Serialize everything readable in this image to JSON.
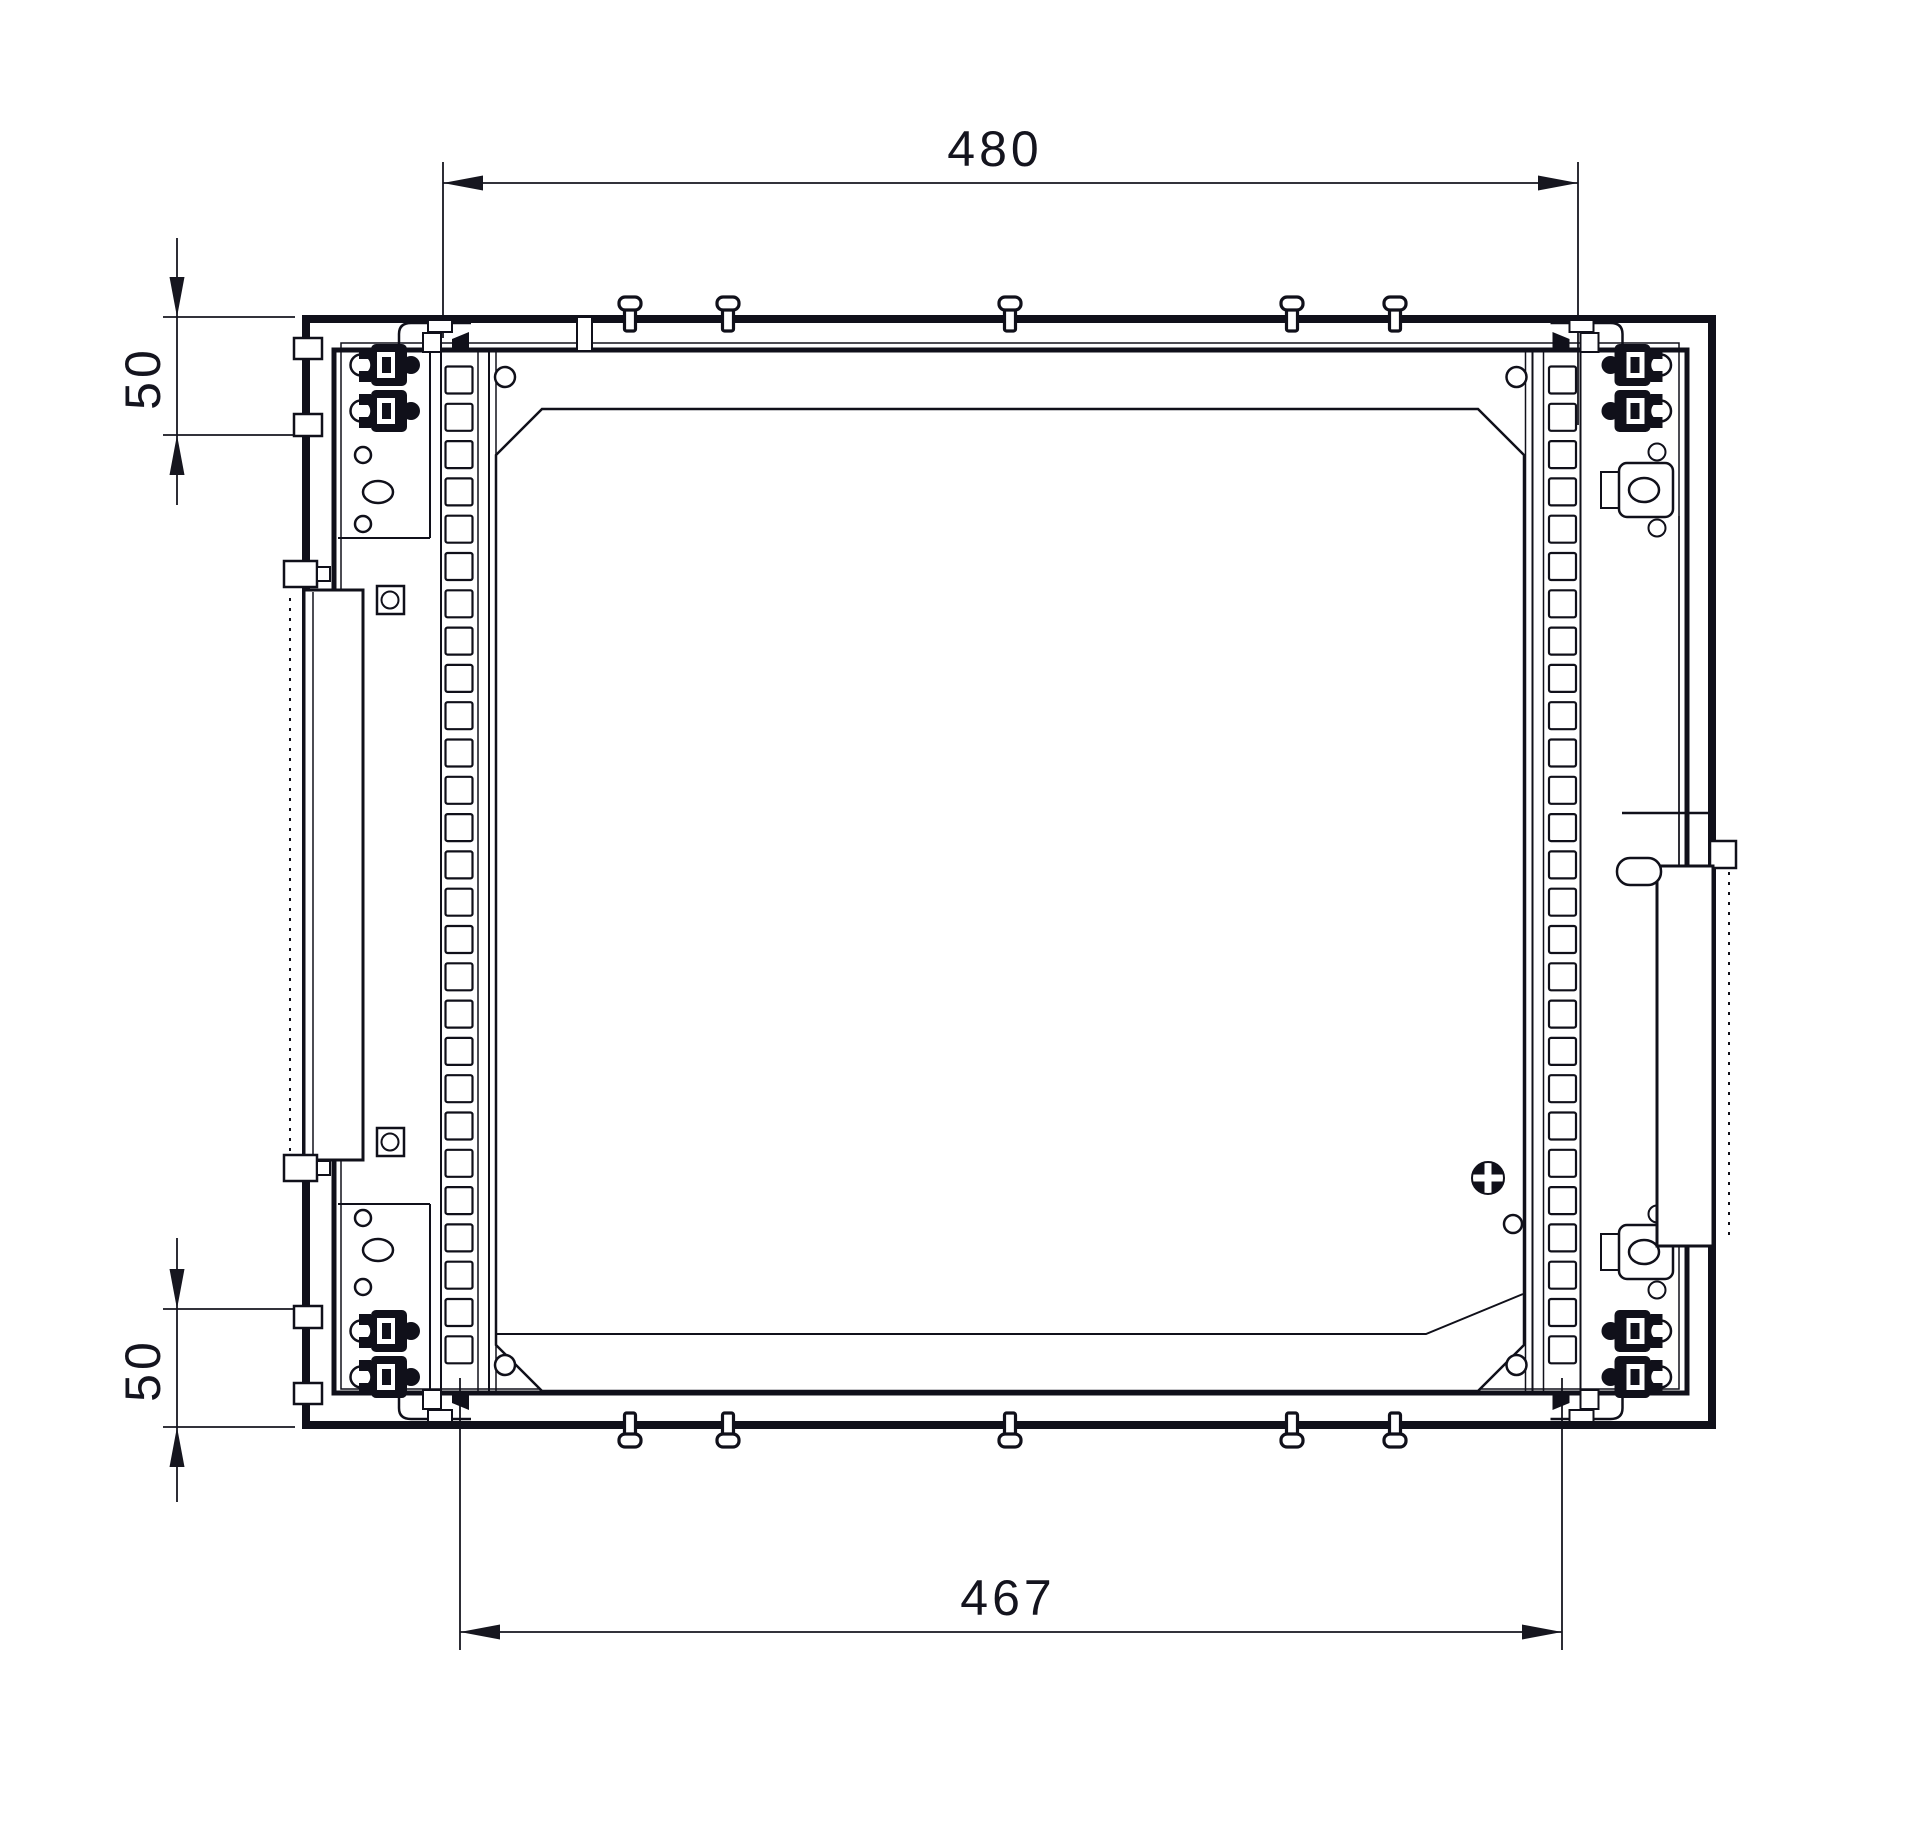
{
  "drawing": {
    "type": "technical-cad-drawing",
    "subject": "rack-mount frame, top view with mounting rails",
    "background": "#ffffff",
    "line_color": "#10101a",
    "dimensions": [
      {
        "id": "top-width",
        "value": "480"
      },
      {
        "id": "bottom-width",
        "value": "467"
      },
      {
        "id": "top-offset",
        "value": "50"
      },
      {
        "id": "bottom-offset",
        "value": "50"
      }
    ],
    "rack_rail": {
      "hole_count": 27,
      "hole_size": 27,
      "hole_pitch": 37.3,
      "first_hole_center_y": 380,
      "left_hole_x": 445.5,
      "right_hole_x": 1549
    },
    "screws": {
      "x_positions": [
        630,
        728,
        1010,
        1292,
        1395
      ],
      "top_base_y": 331,
      "bottom_base_y": 1413
    }
  }
}
